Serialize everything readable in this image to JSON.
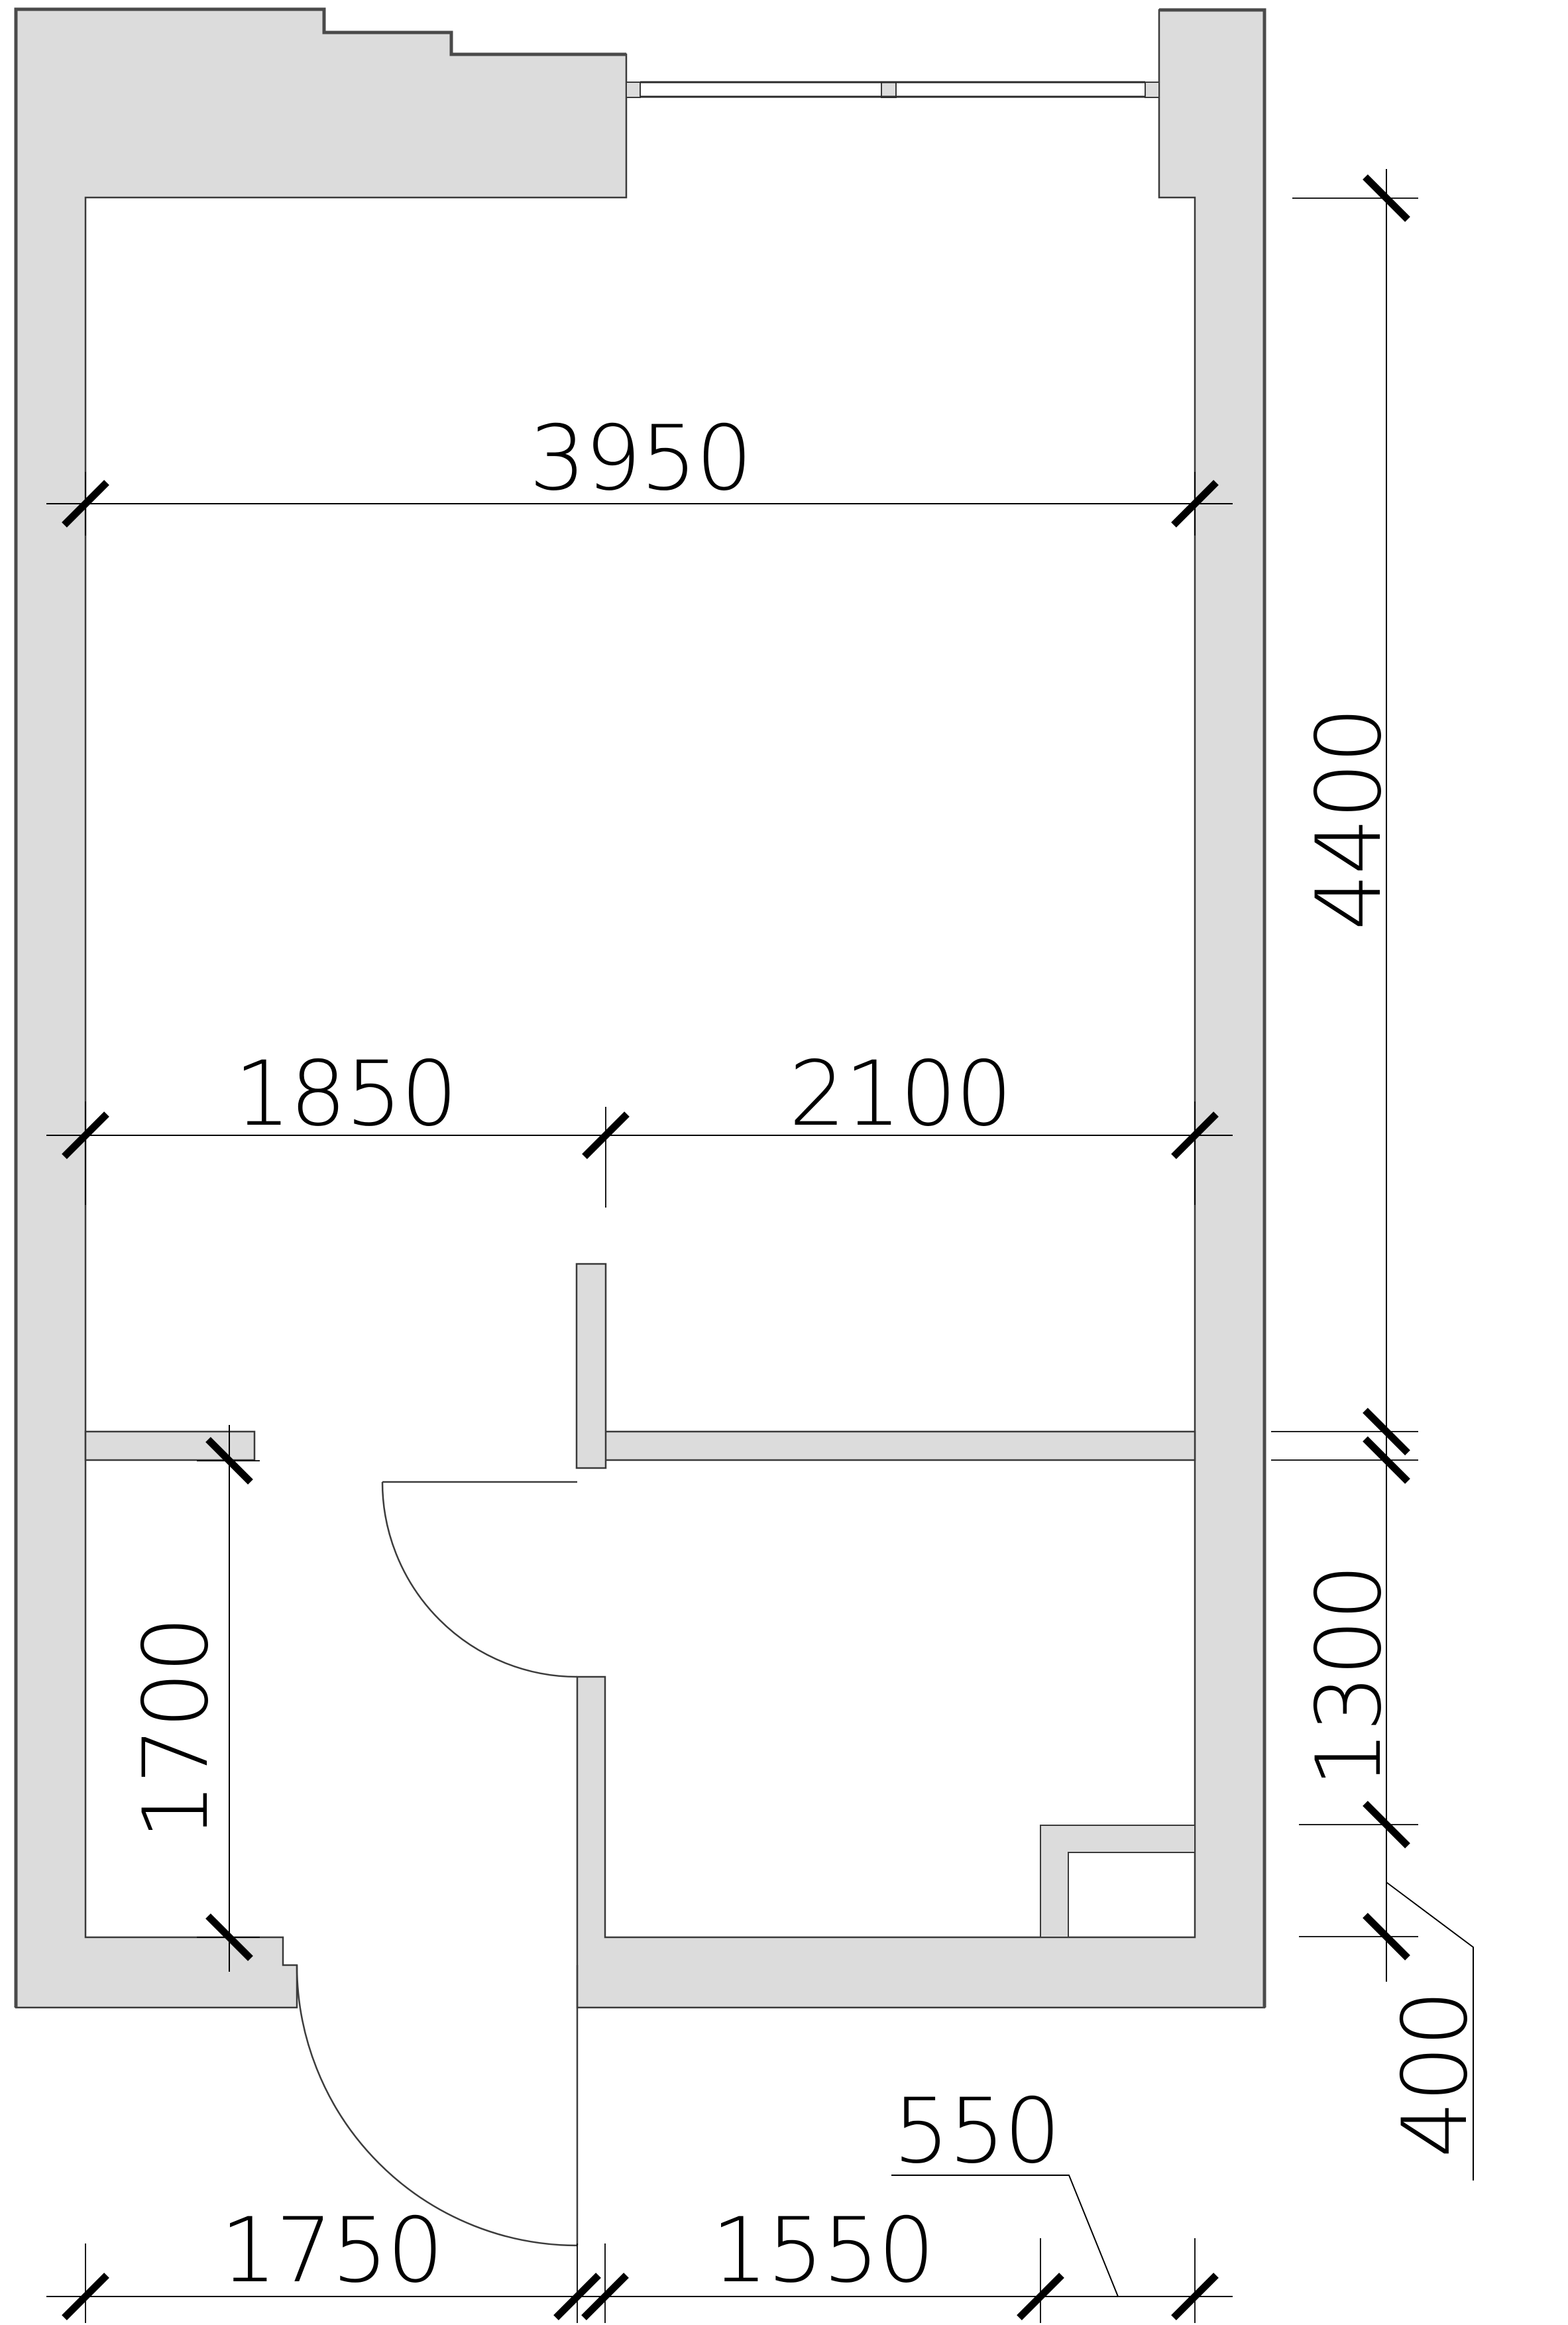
{
  "drawing": {
    "kind": "floor-plan",
    "units": "mm"
  },
  "colors": {
    "wall_fill": "#dcdcdc",
    "wall_stroke": "#3a3a3a",
    "dimension_color": "#000000",
    "background": "#ffffff"
  },
  "dimensions": {
    "top_width": {
      "value": "3950"
    },
    "split_left": {
      "value": "1850"
    },
    "split_right": {
      "value": "2100"
    },
    "right_main_height": {
      "value": "4400"
    },
    "right_lower_height": {
      "value": "1300"
    },
    "right_shaft_height": {
      "value": "400"
    },
    "left_hall_height": {
      "value": "1700"
    },
    "bottom_left": {
      "value": "1750"
    },
    "bottom_middle": {
      "value": "1550"
    },
    "bottom_shaft_width": {
      "value": "550"
    }
  }
}
